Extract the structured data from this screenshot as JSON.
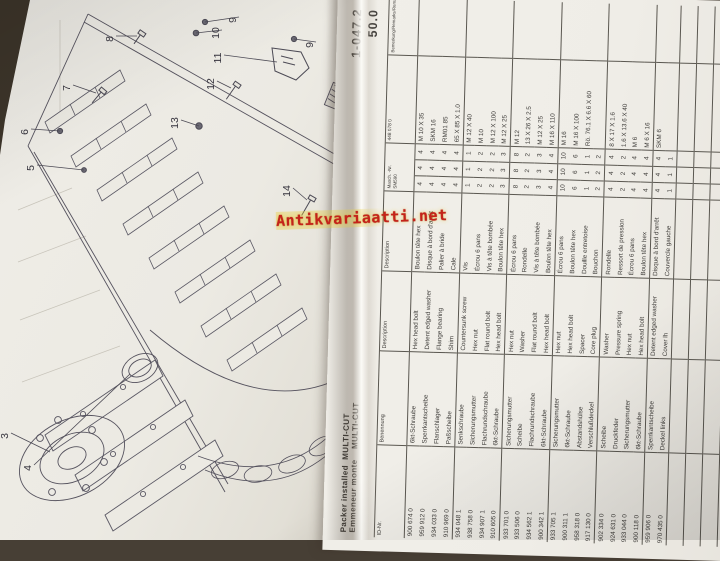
{
  "watermark": {
    "text": "Antikvariaatti.net",
    "color": "#c4231a"
  },
  "table": {
    "page_ref": "1-047.2",
    "page_no": "50.0",
    "title_line1": "Packer installed  MULTI-CUT",
    "title_line2": "Emmeneur monte    MULTI-CUT",
    "headers": {
      "id": "ID-Nr.",
      "german": "Benennung",
      "english": "Description",
      "french": "Description",
      "masch": "Masch. -Nr.",
      "model": "SM590",
      "dim_ref": "448 078 0",
      "remarks": "Bemerkung/Remarks/Remarque"
    },
    "parts": [
      {
        "id": "900 674 0",
        "de": "6kt-Schraube",
        "en": "Hex head bolt",
        "fr": "Boulon tête hex",
        "dim": "M 10 X 35",
        "q": [
          4,
          4,
          4
        ]
      },
      {
        "id": "959 912 0",
        "de": "Sperrkantscheibe",
        "en": "Detent edged washer",
        "fr": "Disque à bord d'arrêt",
        "dim": "SKM 16",
        "q": [
          4,
          4,
          4
        ]
      },
      {
        "id": "934 033 0",
        "de": "Flanschlager",
        "en": "Flange bearing",
        "fr": "Palier à bride",
        "dim": "RM01 85",
        "q": [
          4,
          4,
          4
        ]
      },
      {
        "id": "910 969 0",
        "de": "Paßscheibe",
        "en": "Shim",
        "fr": "Cale",
        "dim": "65 X 85 X 1.0",
        "q": [
          4,
          4,
          4
        ]
      },
      {
        "id": "934 048 1",
        "de": "Senkschraube",
        "en": "Countersunk screw",
        "fr": "Vis",
        "dim": "M 12 X 40",
        "q": [
          1,
          1,
          1
        ]
      },
      {
        "id": "938 758 0",
        "de": "Sicherungsmutter",
        "en": "Hex nut",
        "fr": "Écrou 6 pans",
        "dim": "M 10",
        "q": [
          2,
          2,
          2
        ]
      },
      {
        "id": "934 907 1",
        "de": "Flachrundschraube",
        "en": "Flat round bolt",
        "fr": "Vis à tête bombée",
        "dim": "M 12 X 100",
        "q": [
          2,
          2,
          2
        ]
      },
      {
        "id": "910 605 0",
        "de": "6kt-Schraube",
        "en": "Hex head bolt",
        "fr": "Boulon tête hex",
        "dim": "M 12 X 25",
        "q": [
          3,
          3,
          3
        ]
      },
      {
        "id": "933 701 0",
        "de": "Sicherungsmutter",
        "en": "Hex nut",
        "fr": "Écrou 6 pans",
        "dim": "M 12",
        "q": [
          8,
          8,
          8
        ]
      },
      {
        "id": "933 506 0",
        "de": "Scheibe",
        "en": "Washer",
        "fr": "Rondelle",
        "dim": "13 X 26 X 2.5",
        "q": [
          2,
          2,
          2
        ]
      },
      {
        "id": "934 562 1",
        "de": "Flachrundschraube",
        "en": "Flat round bolt",
        "fr": "Vis à tête bombée",
        "dim": "M 12 X 25",
        "q": [
          3,
          3,
          3
        ]
      },
      {
        "id": "900 342 1",
        "de": "6kt-Schraube",
        "en": "Hex head bolt",
        "fr": "Boulon tête hex",
        "dim": "M 16 X 110",
        "q": [
          4,
          4,
          4
        ]
      },
      {
        "id": "933 705 1",
        "de": "Sicherungsmutter",
        "en": "Hex nut",
        "fr": "Écrou 6 pans",
        "dim": "M 16",
        "q": [
          10,
          10,
          10
        ]
      },
      {
        "id": "900 311 1",
        "de": "6kt-Schraube",
        "en": "Hex head bolt",
        "fr": "Boulon tête hex",
        "dim": "M 16 X 100",
        "q": [
          6,
          6,
          6
        ]
      },
      {
        "id": "958 318 0",
        "de": "Abstandshülse",
        "en": "Spacer",
        "fr": "Douille entretoise",
        "dim": "Rö. 76.1 X 6.6 X 60",
        "q": [
          1,
          1,
          1
        ]
      },
      {
        "id": "917 130 0",
        "de": "Verschlußdeckel",
        "en": "Core plug",
        "fr": "Bouchon",
        "dim": "",
        "q": [
          2,
          2,
          2
        ]
      },
      {
        "id": "902 334 0",
        "de": "Scheibe",
        "en": "Washer",
        "fr": "Rondelle",
        "dim": "8 X 17 X 1.6",
        "q": [
          4,
          4,
          4
        ]
      },
      {
        "id": "924 631 0",
        "de": "Druckfeder",
        "en": "Pressure spring",
        "fr": "Ressort de pression",
        "dim": "1.6 X 13.6 X 40",
        "q": [
          2,
          2,
          2
        ]
      },
      {
        "id": "933 044 0",
        "de": "Sicherungsmutter",
        "en": "Hex nut",
        "fr": "Écrou 6 pans",
        "dim": "M 6",
        "q": [
          4,
          4,
          4
        ]
      },
      {
        "id": "900 118 0",
        "de": "6kt-Schraube",
        "en": "Hex head bolt",
        "fr": "Boulon tête hex",
        "dim": "M 6 X 16",
        "q": [
          4,
          4,
          4
        ]
      },
      {
        "id": "959 906 0",
        "de": "Sperrkantscheibe",
        "en": "Detent edged washer",
        "fr": "Disque à bord d'arrêt",
        "dim": "SKM 6",
        "q": [
          4,
          4,
          4
        ]
      },
      {
        "id": "970 435 0",
        "de": "Deckel links",
        "en": "Cover lh",
        "fr": "Couvercle gauche",
        "dim": "",
        "q": [
          1,
          1,
          1
        ]
      }
    ]
  },
  "diagram": {
    "callouts": [
      {
        "n": "3",
        "x": 8,
        "y": 436,
        "tx": 50,
        "ty": 452
      },
      {
        "n": "4",
        "x": 31,
        "y": 468,
        "tx": 130,
        "ty": 374
      },
      {
        "n": "5",
        "x": 34,
        "y": 168,
        "tx": 84,
        "ty": 170
      },
      {
        "n": "6",
        "x": 28,
        "y": 132,
        "tx": 60,
        "ty": 131
      },
      {
        "n": "7",
        "x": 70,
        "y": 88,
        "tx": 96,
        "ty": 93
      },
      {
        "n": "8",
        "x": 113,
        "y": 39,
        "tx": 137,
        "ty": 36
      },
      {
        "n": "9",
        "x": 236,
        "y": 20,
        "tx": 205,
        "ty": 22
      },
      {
        "n": "10",
        "x": 219,
        "y": 33,
        "tx": 196,
        "ty": 33
      },
      {
        "n": "11",
        "x": 221,
        "y": 58,
        "tx": 277,
        "ty": 62
      },
      {
        "n": "12",
        "x": 214,
        "y": 84,
        "tx": 231,
        "ty": 88
      },
      {
        "n": "13",
        "x": 178,
        "y": 123,
        "tx": 199,
        "ty": 126
      },
      {
        "n": "14",
        "x": 290,
        "y": 191,
        "tx": 307,
        "ty": 200
      },
      {
        "n": "9",
        "x": 313,
        "y": 45,
        "tx": 294,
        "ty": 39
      },
      {
        "n": "15",
        "x": 352,
        "y": 104,
        "tx": 342,
        "ty": 96
      }
    ]
  }
}
